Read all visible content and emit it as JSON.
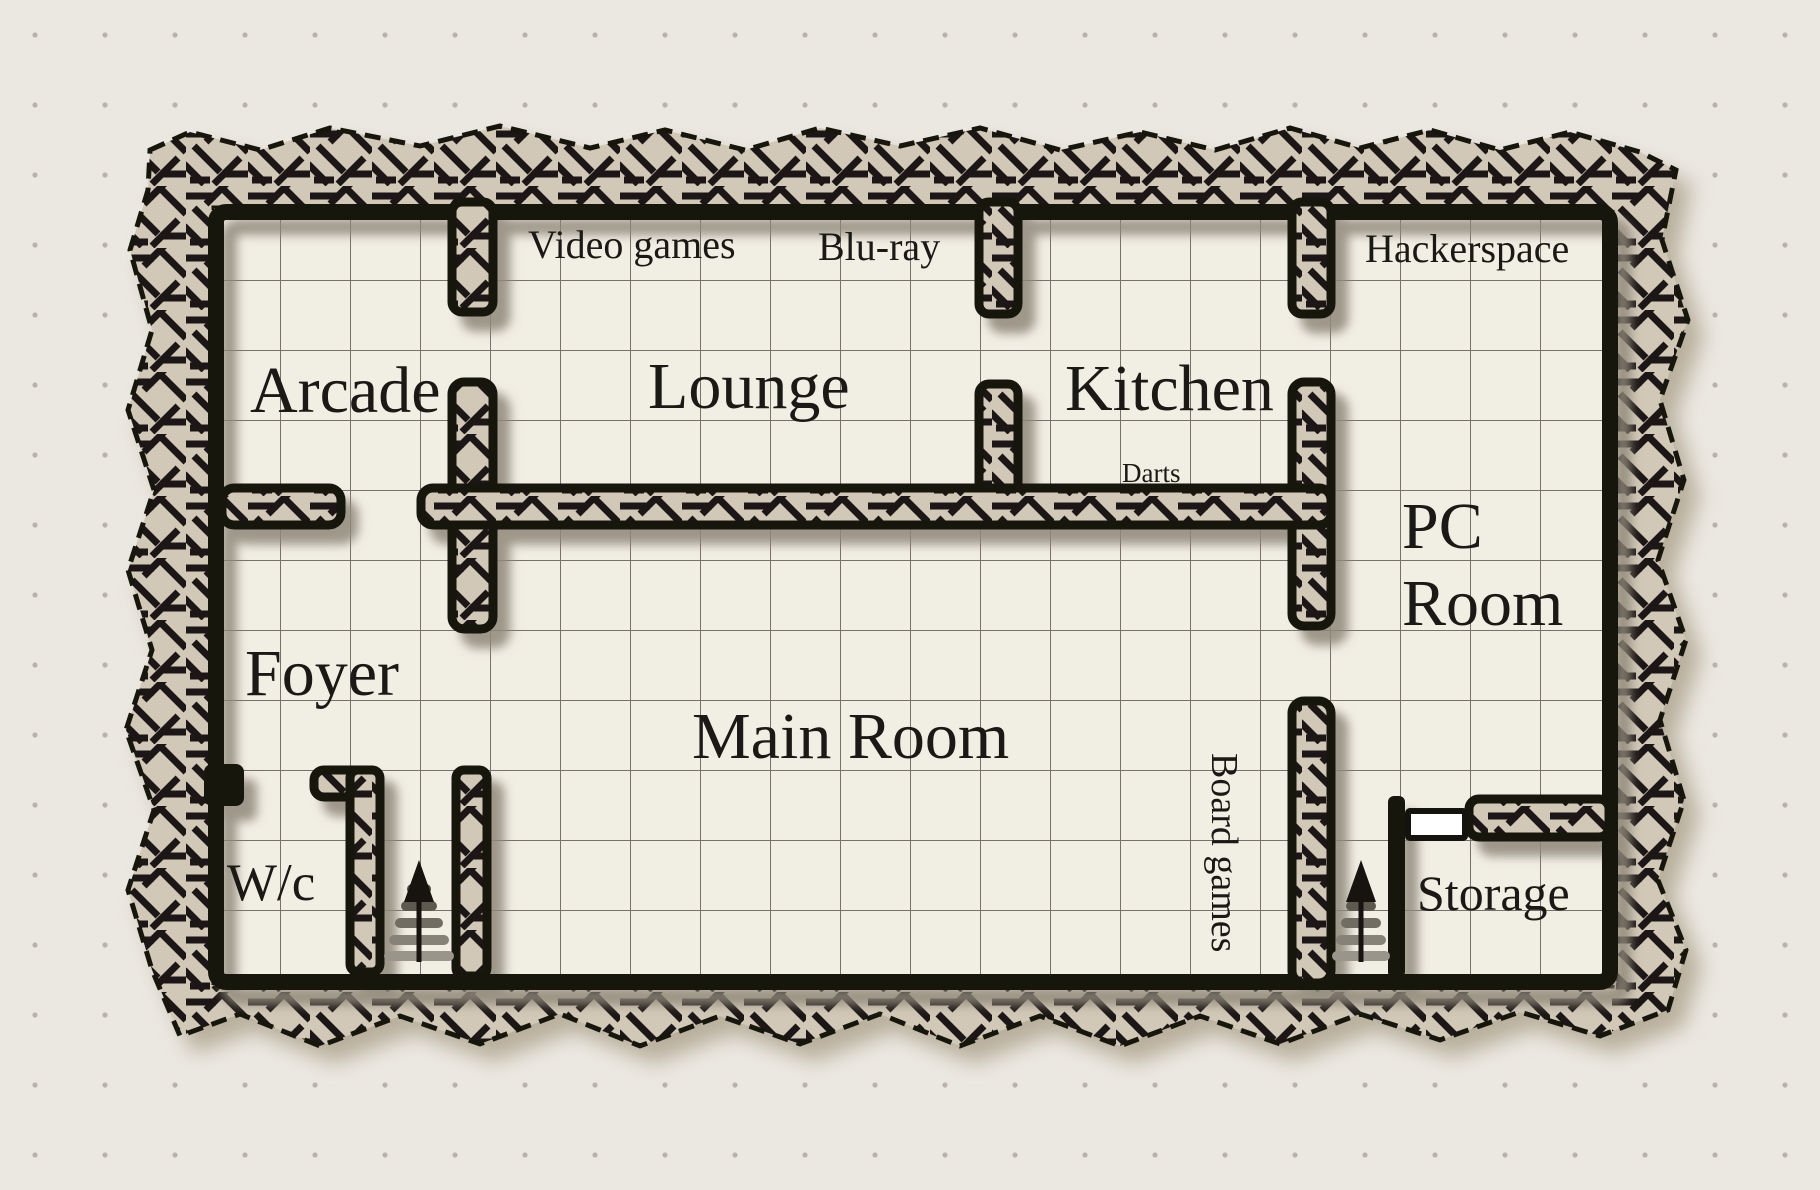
{
  "map": {
    "type": "floorplan-dungeon-style",
    "rooms": [
      {
        "id": "arcade",
        "label": "Arcade"
      },
      {
        "id": "lounge",
        "label": "Lounge"
      },
      {
        "id": "kitchen",
        "label": "Kitchen"
      },
      {
        "id": "hackerspace",
        "label": "Hackerspace"
      },
      {
        "id": "pc-room",
        "label": "PC Room",
        "lines": [
          "PC",
          "Room"
        ]
      },
      {
        "id": "foyer",
        "label": "Foyer"
      },
      {
        "id": "main-room",
        "label": "Main Room"
      },
      {
        "id": "wc",
        "label": "W/c"
      },
      {
        "id": "storage",
        "label": "Storage"
      }
    ],
    "annotations": [
      {
        "id": "video-games",
        "label": "Video games"
      },
      {
        "id": "blu-ray",
        "label": "Blu-ray"
      },
      {
        "id": "darts",
        "label": "Darts"
      },
      {
        "id": "board-games",
        "label": "Board games"
      }
    ],
    "features": {
      "stairs": [
        {
          "location": "south wall near W/c",
          "direction": "up"
        },
        {
          "location": "south wall near Storage",
          "direction": "up"
        }
      ],
      "doors": [
        {
          "location": "Storage north-west corner",
          "type": "plain door"
        }
      ]
    },
    "colors": {
      "background": "#ebe8e1",
      "floor": "#f1eee4",
      "wall_ink": "#17140f",
      "wall_hatch_fill": "#d2c8b8",
      "shadow": "#8f8779",
      "grid_line": "#605c55",
      "background_dot": "#b8b4aa",
      "door_fill": "#ffffff",
      "text": "#1b1915"
    }
  }
}
